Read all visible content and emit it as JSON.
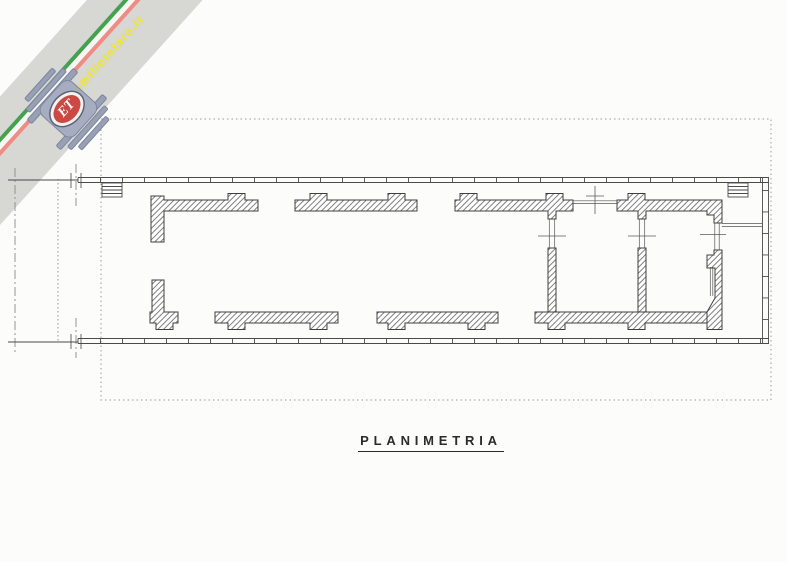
{
  "watermark": {
    "url_text": "www.emiliototaro.it",
    "logo_text": "ET",
    "colors": {
      "band_gray": "#d7d7d3",
      "stripe_green": "#44a24e",
      "stripe_red": "#ef8c86",
      "url_yellow": "#f2ea3a",
      "wing_gray": "#98a0b4",
      "logo_red": "#cb4843"
    }
  },
  "drawing": {
    "title": "PLANIMETRIA",
    "type": "floor-plan",
    "line_color": "#3f3f3f",
    "paper_color": "#fcfcfa"
  }
}
